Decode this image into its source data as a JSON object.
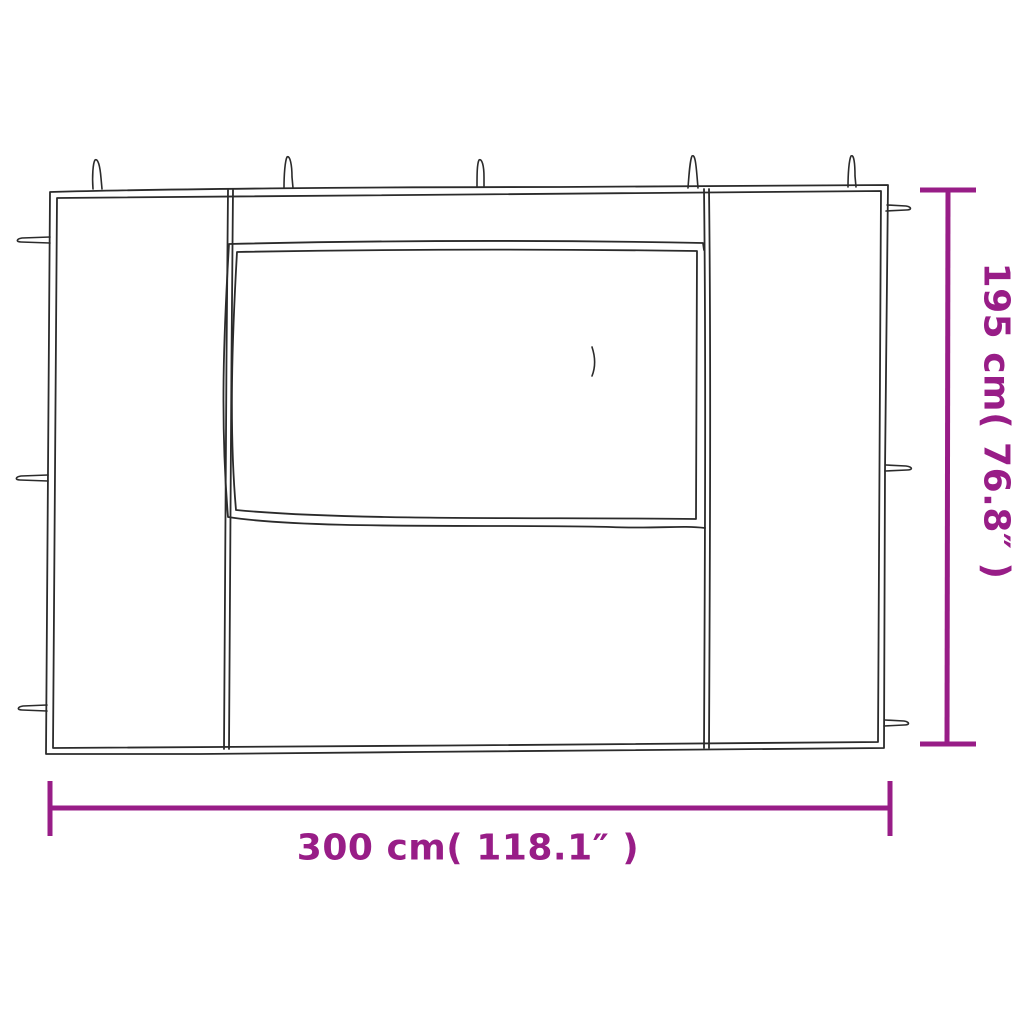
{
  "page": {
    "background_color": "#ffffff"
  },
  "diagram": {
    "name": "gazebo-sidewall-with-window-dimension-diagram",
    "subject": "party tent sidewall panel with window, line drawing",
    "line_color": "#2b2b2b",
    "accent_color": "#981D87",
    "width_dimension": {
      "label": "300 cm( 118.1″ )",
      "cm": 300,
      "inches": 118.1
    },
    "height_dimension": {
      "label": "195 cm( 76.8″ )",
      "cm": 195,
      "inches": 76.8
    }
  }
}
